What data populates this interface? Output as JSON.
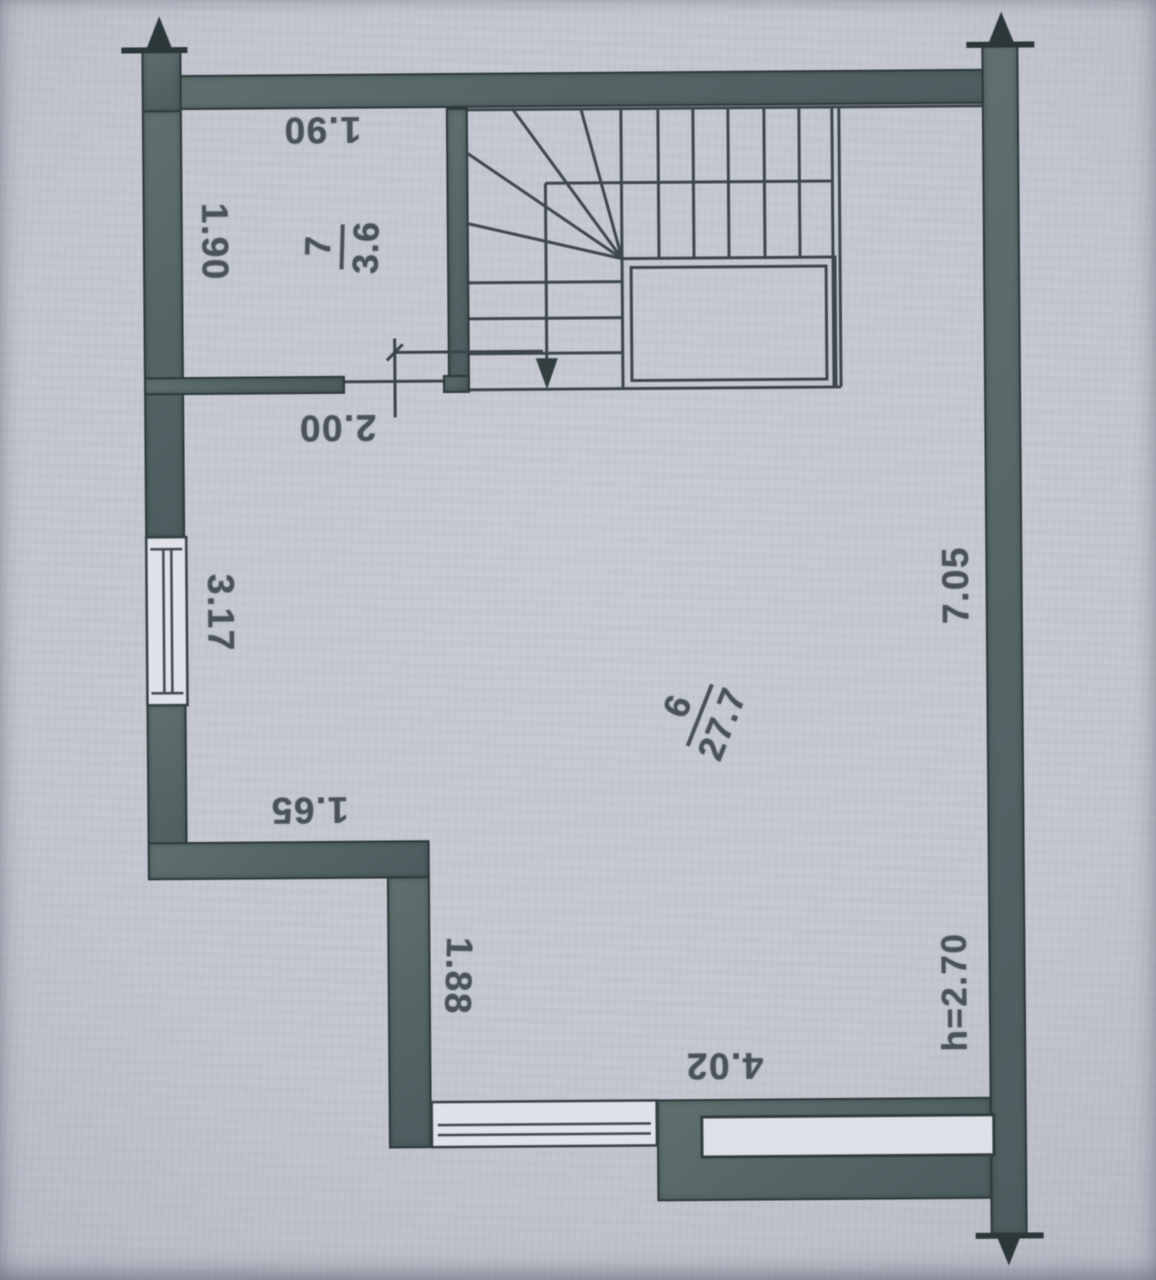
{
  "document": {
    "kind": "scanned floor plan drawing"
  },
  "rooms": [
    {
      "number": "7",
      "area": "3.6"
    },
    {
      "number": "6",
      "area": "27.7"
    }
  ],
  "dimensions": {
    "room7_top_width": "1.90",
    "room7_left_height": "1.90",
    "hall_opening_width": "2.00",
    "left_window_width": "3.17",
    "ledge_width": "1.65",
    "ledge_depth": "1.88",
    "bottom_window_width": "4.02",
    "right_side_height": "7.05",
    "ceiling_height": "h=2.70"
  },
  "icons": {
    "section_arrow_up": "▲",
    "section_arrow_down": "▼",
    "stair_direction_arrow": "▼"
  },
  "colors": {
    "paper": "#c4c8d1",
    "wall_fill": "#57666a",
    "wall_edge": "#2e393b",
    "line": "#3d474d",
    "text": "#49525b"
  }
}
